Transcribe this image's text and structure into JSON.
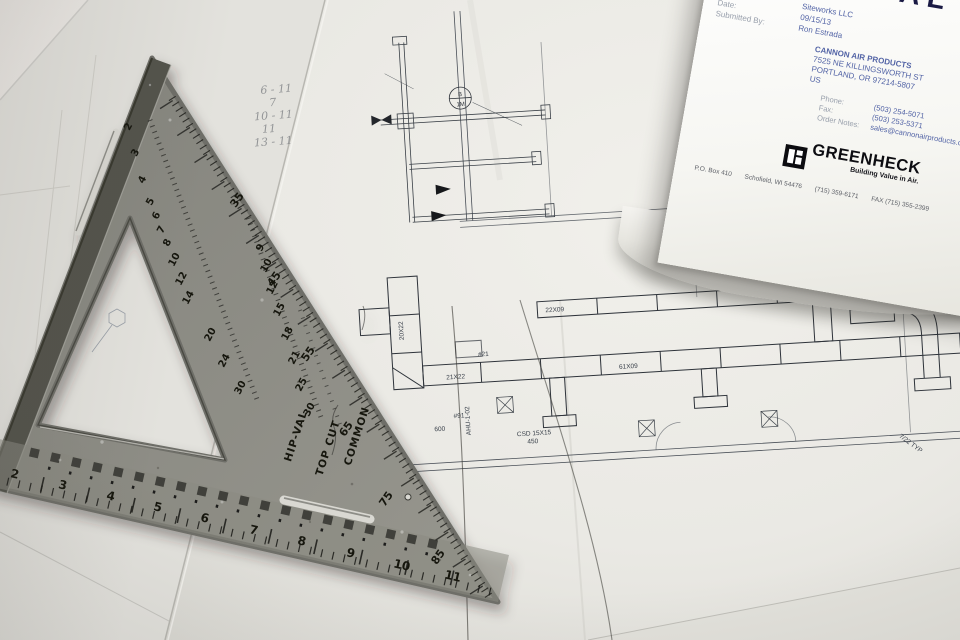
{
  "scene": {
    "description": "HVAC construction blueprint spread on a table with a metal rafter speed square laid on top and a Greenheck submittal cover sheet in the upper-right corner"
  },
  "submittal": {
    "title": "SUBMITTAL",
    "job_title_label": "Job Title:",
    "job_title_value": "Siteworks LLC",
    "date_label": "Date:",
    "date_value": "09/15/13",
    "submitted_by_label": "Submitted By:",
    "submitted_by_value": "Ron Estrada",
    "company_lines": [
      "CANNON AIR PRODUCTS",
      "7525 NE KILLINGSWORTH ST",
      "PORTLAND, OR 97214-5807",
      "US"
    ],
    "phone_label": "Phone:",
    "phone_value": "(503) 254-5071",
    "fax_label": "Fax:",
    "fax_value": "(503) 253-5371",
    "notes_label": "Order Notes:",
    "notes_value": "sales@cannonairproducts.com",
    "brand_name": "GREENHECK",
    "brand_tagline": "Building Value in Air.",
    "brand_address": [
      "P.O. Box 410",
      "Schofield, WI 54476",
      "(715) 359-6171",
      "FAX (715) 355-2399"
    ]
  },
  "speed_square": {
    "edge_labels": {
      "hip_val": "HIP-VAL",
      "top_cut": "TOP CUT",
      "common": "COMMON"
    },
    "inch_numbers_bottom": [
      "2",
      "3",
      "4",
      "5",
      "6",
      "7",
      "8",
      "9",
      "10",
      "11"
    ],
    "hip_val_numbers": [
      "2",
      "3",
      "4",
      "5",
      "6",
      "7",
      "8",
      "10",
      "12",
      "14",
      "20",
      "24",
      "30"
    ],
    "common_numbers": [
      "9",
      "10",
      "12",
      "15",
      "18",
      "21",
      "25",
      "30"
    ],
    "degree_numbers": [
      "35",
      "45",
      "55",
      "65",
      "75",
      "85"
    ]
  },
  "blueprint": {
    "labels": {
      "duct1": "21X22",
      "duct2": "20X22",
      "duct3": "61X09",
      "duct4": "22X09",
      "duct5": "16X10",
      "duct6": "18X10 500",
      "reg1": "CSD 15X15",
      "reg1_cfm": "450",
      "reg2_cfm": "600",
      "unit": "AHU-1-02",
      "tag1": "#21",
      "tag2": "#91",
      "typ": "7/22 TYP",
      "tag_circle_top": "B",
      "tag_circle_bottom": "1M"
    },
    "handwritten_notes": [
      "6 - 11",
      "7",
      "10 - 11",
      "11",
      "13 - 11"
    ]
  }
}
